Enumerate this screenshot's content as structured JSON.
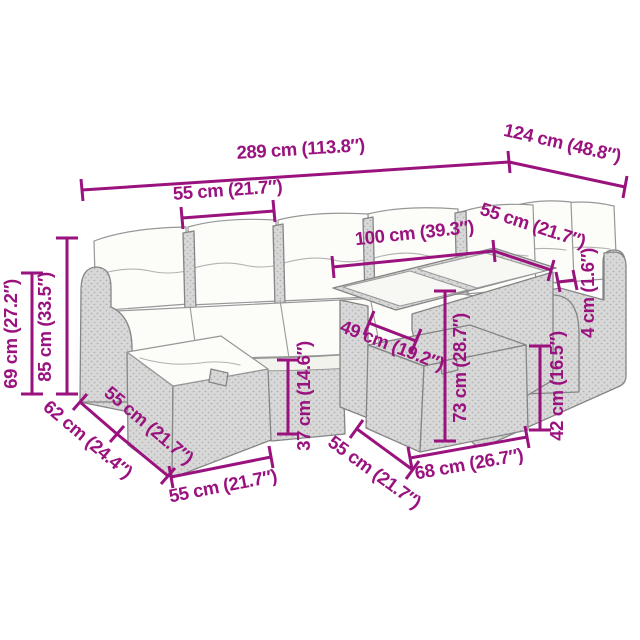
{
  "figure": {
    "description": "Dimension diagram of a modular poly rattan garden lounge set with white cushions, two footstools and a glass-top table",
    "style": "technical line drawing on white background",
    "colors": {
      "accent": "#9a127e",
      "background": "#ffffff",
      "rattan_fill": "#d8d8d8",
      "rattan_dot": "#b4b4b4",
      "outline": "#858585",
      "cushion": "#fcfcf9"
    }
  },
  "dims": [
    {
      "id": "overall-length",
      "label": "289 cm (113.8″)"
    },
    {
      "id": "overall-depth",
      "label": "124 cm (48.8″)"
    },
    {
      "id": "seat-module-width",
      "label": "55 cm (21.7″)"
    },
    {
      "id": "table-length",
      "label": "100 cm (39.3″)"
    },
    {
      "id": "table-depth",
      "label": "55 cm (21.7″)"
    },
    {
      "id": "tabletop-thickness",
      "label": "4 cm (1.6″)"
    },
    {
      "id": "armrest-height",
      "label": "69 cm (27.2″)"
    },
    {
      "id": "back-height",
      "label": "85 cm (33.5″)"
    },
    {
      "id": "sofa-depth",
      "label": "62 cm (24.4″)"
    },
    {
      "id": "footstool-depth",
      "label": "55 cm (21.7″)"
    },
    {
      "id": "seat-height",
      "label": "37 cm (14.6″)"
    },
    {
      "id": "footstool-width",
      "label": "55 cm (21.7″)"
    },
    {
      "id": "table-stool-depth",
      "label": "55 cm (21.7″)"
    },
    {
      "id": "table-stool-width",
      "label": "68 cm (26.7″)"
    },
    {
      "id": "table-height",
      "label": "73 cm (28.7″)"
    },
    {
      "id": "table-clearance-width",
      "label": "49 cm (19.2″)"
    },
    {
      "id": "stool-height",
      "label": "42 cm (16.5″)"
    }
  ]
}
